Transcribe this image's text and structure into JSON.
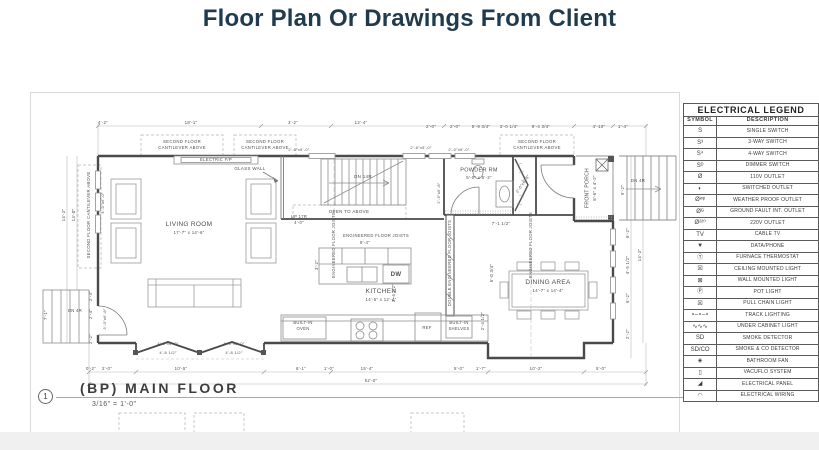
{
  "page": {
    "title": "Floor Plan Or Drawings From Client"
  },
  "plan": {
    "sheet": {
      "number": "1",
      "label": "(BP) MAIN FLOOR",
      "scale": "3/16\" = 1'-0\""
    },
    "room_labels": [
      {
        "t": "LIVING ROOM",
        "x": 158,
        "y": 132,
        "s": 6.5
      },
      {
        "t": "17'-7″ x 14'-6″",
        "x": 158,
        "y": 140,
        "s": 4.3
      },
      {
        "t": "KITCHEN",
        "x": 350,
        "y": 199,
        "s": 6.5
      },
      {
        "t": "14'-5″ x 12'-4″",
        "x": 350,
        "y": 207,
        "s": 4.3
      },
      {
        "t": "DINING AREA",
        "x": 517,
        "y": 190,
        "s": 6.5
      },
      {
        "t": "14'-7″ x 14'-4″",
        "x": 517,
        "y": 198,
        "s": 4.3
      },
      {
        "t": "POWDER RM",
        "x": 448,
        "y": 78,
        "s": 5.5
      },
      {
        "t": "5'-0″ x 5'-3″",
        "x": 448,
        "y": 85,
        "s": 4.3
      },
      {
        "t": "FRONT PORCH",
        "x": 557,
        "y": 95,
        "r": -90,
        "s": 5
      },
      {
        "t": "8'-6″ x 4'-2″",
        "x": 564,
        "y": 95,
        "r": -90,
        "s": 4.3
      }
    ],
    "annotations": [
      {
        "t": "SECOND FLOOR",
        "x": 151,
        "y": 49,
        "s": 4.3
      },
      {
        "t": "CANTILEVER ABOVE",
        "x": 151,
        "y": 55,
        "s": 4.3
      },
      {
        "t": "SECOND FLOOR",
        "x": 234,
        "y": 49,
        "s": 4.3
      },
      {
        "t": "CANTILEVER ABOVE",
        "x": 234,
        "y": 55,
        "s": 4.3
      },
      {
        "t": "SECOND FLOOR",
        "x": 506,
        "y": 49,
        "s": 4.3
      },
      {
        "t": "CANTILEVER ABOVE",
        "x": 506,
        "y": 55,
        "s": 4.3
      },
      {
        "t": "SECOND FLOOR CANTILEVER ABOVE",
        "x": 58,
        "y": 122,
        "r": -90,
        "s": 4.3
      },
      {
        "t": "ELECTRIC F/P",
        "x": 185,
        "y": 67,
        "s": 4.2
      },
      {
        "t": "GLASS WALL",
        "x": 219,
        "y": 76,
        "s": 4.5
      },
      {
        "t": "DN 14R",
        "x": 332,
        "y": 84,
        "s": 4.5
      },
      {
        "t": "OPEN TO ABOVE",
        "x": 318,
        "y": 119,
        "s": 4.5
      },
      {
        "t": "UP 17R",
        "x": 268,
        "y": 124,
        "s": 4.2
      },
      {
        "t": "4'-0″",
        "x": 268,
        "y": 130,
        "s": 4.2
      },
      {
        "t": "ENGINEERED FLOOR JOISTS",
        "x": 345,
        "y": 143,
        "s": 4.2
      },
      {
        "t": "ENGINEERED FLOOR JOISTS",
        "x": 303,
        "y": 152,
        "r": -90,
        "s": 4.2
      },
      {
        "t": "DOUBLE ENGINEERED FLOOR JOISTS",
        "x": 419,
        "y": 170,
        "r": -90,
        "s": 4.2
      },
      {
        "t": "ENGINEERED FLOOR JOISTS",
        "x": 500,
        "y": 152,
        "r": -90,
        "s": 4.2
      },
      {
        "t": "BUILT-IN",
        "x": 272,
        "y": 230,
        "s": 4.2
      },
      {
        "t": "OVEN",
        "x": 272,
        "y": 236,
        "s": 4.2
      },
      {
        "t": "DW",
        "x": 365,
        "y": 182,
        "s": 6,
        "b": 1
      },
      {
        "t": "REF",
        "x": 396,
        "y": 235,
        "s": 4.2
      },
      {
        "t": "BUILT-IN",
        "x": 428,
        "y": 230,
        "s": 4.2
      },
      {
        "t": "SHELVES",
        "x": 428,
        "y": 236,
        "s": 4.2
      },
      {
        "t": "DN 4R",
        "x": 44,
        "y": 218,
        "s": 4.2
      },
      {
        "t": "DN 4R",
        "x": 607,
        "y": 88,
        "s": 4.2
      }
    ],
    "dimensions": [
      {
        "t": "4'-2″",
        "x": 72,
        "y": 30
      },
      {
        "t": "18'-1″",
        "x": 160,
        "y": 30
      },
      {
        "t": "3'-2″",
        "x": 262,
        "y": 30
      },
      {
        "t": "12'-4″",
        "x": 330,
        "y": 30
      },
      {
        "t": "2'-0″",
        "x": 400,
        "y": 34
      },
      {
        "t": "2'-0″",
        "x": 424,
        "y": 34
      },
      {
        "t": "5'-9 3/4″",
        "x": 450,
        "y": 34
      },
      {
        "t": "3'-0 1/4″",
        "x": 478,
        "y": 34
      },
      {
        "t": "9'-4 3/4″",
        "x": 510,
        "y": 34
      },
      {
        "t": "4'-10″",
        "x": 568,
        "y": 34
      },
      {
        "t": "1'-4″",
        "x": 592,
        "y": 34
      },
      {
        "t": "0'-2″",
        "x": 60,
        "y": 276
      },
      {
        "t": "2'-0″",
        "x": 76,
        "y": 276
      },
      {
        "t": "10'-5″",
        "x": 150,
        "y": 276
      },
      {
        "t": "6'-1″",
        "x": 270,
        "y": 276
      },
      {
        "t": "1'-0″",
        "x": 298,
        "y": 276
      },
      {
        "t": "15'-4″",
        "x": 336,
        "y": 276
      },
      {
        "t": "5'-0″",
        "x": 428,
        "y": 276
      },
      {
        "t": "1'-7″",
        "x": 450,
        "y": 276
      },
      {
        "t": "10'-2″",
        "x": 505,
        "y": 276
      },
      {
        "t": "5'-0″",
        "x": 570,
        "y": 276
      },
      {
        "t": "52'-0″",
        "x": 340,
        "y": 288
      },
      {
        "t": "14'-2″",
        "x": 33,
        "y": 122,
        "r": -90
      },
      {
        "t": "14'-0″",
        "x": 43,
        "y": 122,
        "r": -90
      },
      {
        "t": "2'-4″",
        "x": 60,
        "y": 203,
        "r": -90
      },
      {
        "t": "2'-4″",
        "x": 60,
        "y": 221,
        "r": -90
      },
      {
        "t": "2'-2″",
        "x": 60,
        "y": 246,
        "r": -90
      },
      {
        "t": "7'-1″",
        "x": 15,
        "y": 222,
        "r": -90
      },
      {
        "t": "9'-2″",
        "x": 592,
        "y": 97,
        "r": -90
      },
      {
        "t": "6'-2″",
        "x": 597,
        "y": 140,
        "r": -90
      },
      {
        "t": "4'-5 1/2″",
        "x": 597,
        "y": 172,
        "r": -90
      },
      {
        "t": "6'-2″",
        "x": 597,
        "y": 205,
        "r": -90
      },
      {
        "t": "14'-2″",
        "x": 609,
        "y": 162,
        "r": -90
      },
      {
        "t": "2'-2″",
        "x": 597,
        "y": 241,
        "r": -90
      },
      {
        "t": "7'-1 1/2″",
        "x": 470,
        "y": 131
      },
      {
        "t": "8'-4″",
        "x": 334,
        "y": 150
      },
      {
        "t": "3'-2″",
        "x": 286,
        "y": 172,
        "r": -90
      },
      {
        "t": "3'-4 1/2″",
        "x": 363,
        "y": 200,
        "r": -90
      },
      {
        "t": "5'-0 3/4″",
        "x": 461,
        "y": 180,
        "r": -90
      },
      {
        "t": "2'-4 1/2″",
        "x": 452,
        "y": 228,
        "r": -90
      },
      {
        "t": "2'-6″x5'-0″",
        "x": 268,
        "y": 57,
        "s": 4
      },
      {
        "t": "2'-6″x5'-0″",
        "x": 390,
        "y": 55,
        "s": 4
      },
      {
        "t": "2'-0″x5'-0″",
        "x": 428,
        "y": 57,
        "s": 4
      },
      {
        "t": "4'-0″x5'-0″",
        "x": 137,
        "y": 251,
        "s": 4
      },
      {
        "t": "4'-0″x5'-0″",
        "x": 203,
        "y": 251,
        "s": 4
      },
      {
        "t": "4'-8 1/2″",
        "x": 137,
        "y": 260,
        "s": 4
      },
      {
        "t": "4'-8 1/2″",
        "x": 203,
        "y": 260,
        "s": 4
      },
      {
        "t": "4'-0″x6'-0″",
        "x": 72,
        "y": 110,
        "r": -90,
        "s": 4
      },
      {
        "t": "3'-0″x6'-8″",
        "x": 74,
        "y": 226,
        "r": -90,
        "s": 4
      },
      {
        "t": "2'-6″x6'-8″",
        "x": 408,
        "y": 100,
        "r": -90,
        "s": 4
      },
      {
        "t": "2'-0″x6'-8″",
        "x": 492,
        "y": 91,
        "r": -55,
        "s": 4
      }
    ]
  },
  "legend": {
    "title": "ELECTRICAL LEGEND",
    "columns": [
      "SYMBOL",
      "DESCRIPTION"
    ],
    "rows": [
      {
        "symbol": "S",
        "description": "SINGLE SWITCH"
      },
      {
        "symbol": "S³",
        "description": "3-WAY SWITCH"
      },
      {
        "symbol": "S⁴",
        "description": "4-WAY SWITCH"
      },
      {
        "symbol": "Sᴰ",
        "description": "DIMMER SWITCH"
      },
      {
        "symbol": "Ø",
        "description": "110V OUTLET"
      },
      {
        "symbol": "◐",
        "description": "SWITCHED OUTLET"
      },
      {
        "symbol": "Øʷᵖ",
        "description": "WEATHER PROOF OUTLET"
      },
      {
        "symbol": "Øᴳ",
        "description": "GROUND FAULT INT. OUTLET"
      },
      {
        "symbol": "Ø²²⁰",
        "description": "220V OUTLET"
      },
      {
        "symbol": "TV",
        "description": "CABLE TV"
      },
      {
        "symbol": "▼",
        "description": "DATA/PHONE"
      },
      {
        "symbol": "Ⓣ",
        "description": "FURNACE THERMOSTAT"
      },
      {
        "symbol": "☒",
        "description": "CEILING MOUNTED LIGHT"
      },
      {
        "symbol": "⊠",
        "description": "WALL MOUNTED LIGHT"
      },
      {
        "symbol": "Ⓟ",
        "description": "POT LIGHT"
      },
      {
        "symbol": "☒",
        "description": "PULL CHAIN LIGHT"
      },
      {
        "symbol": "∘–∘–∘",
        "description": "TRACK LIGHTING"
      },
      {
        "symbol": "∿∿∿",
        "description": "UNDER CABINET LIGHT"
      },
      {
        "symbol": "SD",
        "description": "SMOKE DETECTOR"
      },
      {
        "symbol": "SD/CO",
        "description": "SMOKE & CO DETECTOR"
      },
      {
        "symbol": "◈",
        "description": "BATHROOM FAN"
      },
      {
        "symbol": "▯",
        "description": "VACUFLO SYSTEM"
      },
      {
        "symbol": "◢",
        "description": "ELECTRICAL PANEL"
      },
      {
        "symbol": "◠",
        "description": "ELECTRICAL WIRING"
      }
    ]
  }
}
